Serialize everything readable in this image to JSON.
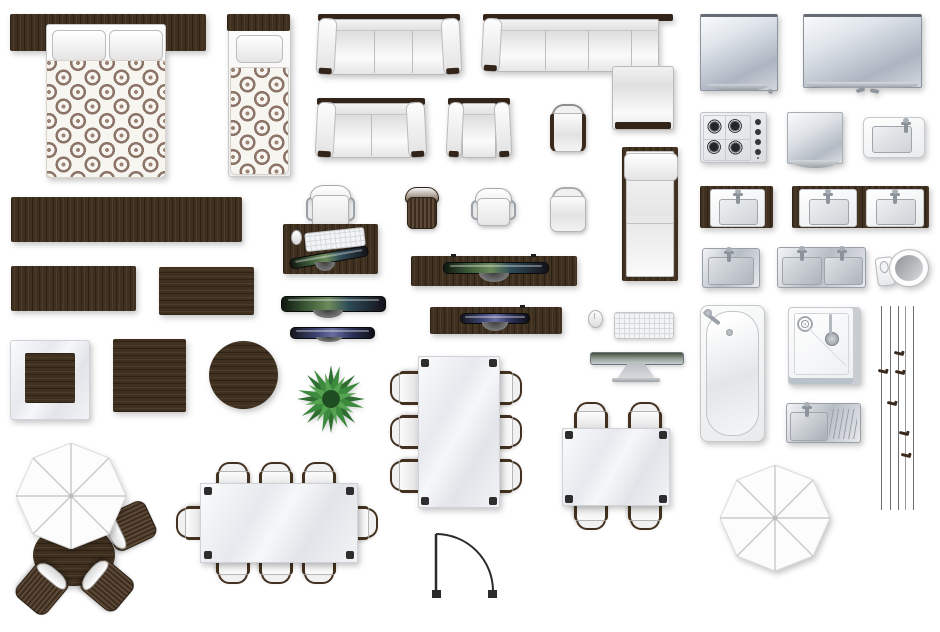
{
  "canvas": {
    "width": 940,
    "height": 632,
    "background": "#ffffff"
  },
  "palette": {
    "dark_wood": "#40301f",
    "fabric_white": "#f3f3f3",
    "duvet_pattern_brown": "#8d7468",
    "glass_gray": "#e9ebef",
    "metal_silver": "#b7bdc5",
    "screen_green": "#6b8a5a",
    "screen_blue": "#696ea0",
    "plant_green": "#3c8a3e",
    "line_dark": "#2b2b2b"
  },
  "labels": {
    "double_bed": "double bed with patterned duvet",
    "single_bed": "single bed with patterned duvet",
    "sofa_3seat": "three-seat sofa",
    "corner_sofa": "corner sofa",
    "sofa_2seat": "two-seat sofa",
    "armchair": "armchair",
    "chair_dark_arms": "chair with dark arms",
    "chair_white": "white chair",
    "chaise_lounge": "chaise lounge",
    "tv_medium": "flat screen tv",
    "tv_wide": "wide flat screen tv",
    "cooktop": "gas cooktop",
    "mirror": "mirror",
    "kitchen_sink": "kitchen sink",
    "vanity_single": "single vanity with wood counter",
    "vanity_double": "double vanity with wood counter",
    "steel_sink_single": "steel sink",
    "steel_sink_double": "double steel sink",
    "toilet": "toilet",
    "bathtub": "bathtub",
    "shower": "shower tray",
    "sink_drainboard": "steel sink with drainboard",
    "curtains": "curtain tracks",
    "sideboard_long": "long sideboard",
    "sideboard_medium": "medium sideboard",
    "sideboard_small": "small sideboard",
    "desk_set": "desk with chair keyboard mouse and monitor",
    "office_chair_rattan": "rattan office chair",
    "office_chair_white": "white office chair",
    "media_console_large": "media console with tv",
    "media_console_small": "media console with tv",
    "tv_panel_green": "wall tv green screen",
    "tv_panel_blue": "wall tv blue screen",
    "mouse": "computer mouse",
    "keyboard": "computer keyboard",
    "monitor_top": "monitor top view",
    "coffee_table_glass": "glass coffee table with wood inset",
    "side_table_square": "square wood table",
    "side_table_round": "round wood table",
    "plant": "potted plant",
    "dining_set_6": "dining table with six chairs",
    "dining_set_4": "square dining table with four chairs",
    "dining_set_8": "dining table with eight chairs",
    "door": "door swing symbol",
    "parasol_table_set": "parasol with round table and three chairs",
    "parasol": "parasol"
  }
}
